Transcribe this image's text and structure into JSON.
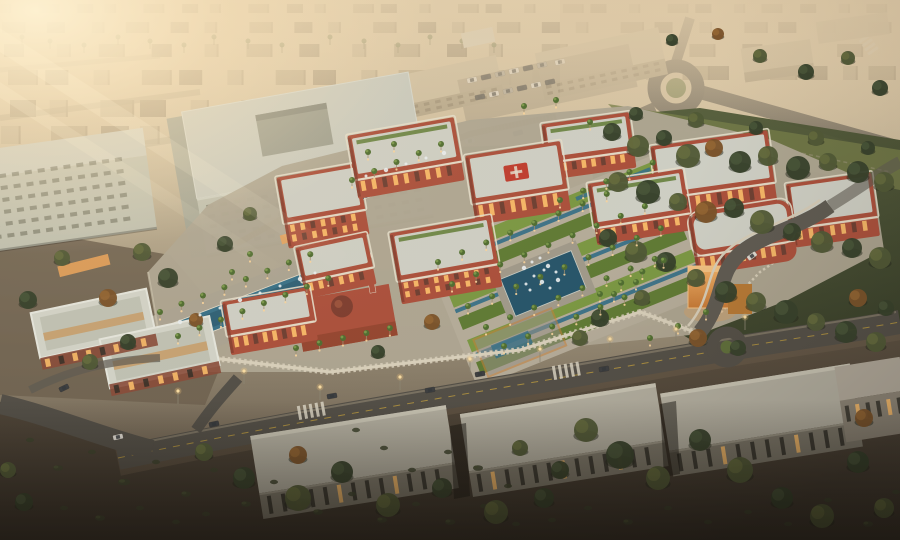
{
  "scene": {
    "description": "Aerial dusk rendering of a red-brick hospital campus with formal palm gardens, fountains, a mosque, a copper gate pavilion, surrounding roads with cars, long warehouse buildings and desert scrub, under a hazy golden sunset glare"
  },
  "palette": {
    "city1": "#b9ab8f",
    "city2": "#a89a7e",
    "city3": "#8d8069",
    "road": "#514e47",
    "roadLight": "#5f5c54",
    "bigFace": "#c2c4b4",
    "bigSide": "#a6a898",
    "bigRoof": "#cdcfc3",
    "pinkPatch": "#bd9a8e",
    "fence": "#9c7a4a",
    "red": "#ad4f3b",
    "redDark": "#7e3a2c",
    "trim": "#e9e2cf",
    "roofPale": "#d2d4ca",
    "lawn": "#5f7c34",
    "lawnBright": "#7b9a43",
    "water": "#35718a",
    "waterDeep": "#24556c",
    "palm": "#4e6e30",
    "palmLite": "#81a14f",
    "pave": "#b1a996",
    "wallCream": "#dcd4bf",
    "copper": "#cf8a3e",
    "copperLit": "#f2b366",
    "scrub": "#5e5242",
    "scrubDark": "#332d25",
    "whRoof": "#b5b2a4",
    "whFace": "#7c786b",
    "winDark": "#2c2a24",
    "winLit": "#ffc06a",
    "carW": "#e2dfd7",
    "carD": "#3a3d40",
    "carS": "#a9a59b",
    "treeA": "#33402a",
    "treeB": "#4e5835",
    "treeC": "#7b5229",
    "treeA2": "#49593a",
    "treeB2": "#68713f",
    "treeC2": "#9a6a33",
    "glow": "#ffd9a0"
  },
  "distant_city": {
    "rows": [
      {
        "y": 4,
        "h": 9,
        "n": 26,
        "x0": 0,
        "x1": 900,
        "s": 0.8
      },
      {
        "y": 22,
        "h": 11,
        "n": 22,
        "x0": 0,
        "x1": 900,
        "s": 0.9
      },
      {
        "y": 44,
        "h": 13,
        "n": 18,
        "x0": 0,
        "x1": 880,
        "s": 1.0
      },
      {
        "y": 66,
        "h": 14,
        "n": 8,
        "x0": 640,
        "x1": 900,
        "s": 1.05
      },
      {
        "y": 70,
        "h": 15,
        "n": 14,
        "x0": 0,
        "x1": 620,
        "s": 1.15
      },
      {
        "y": 100,
        "h": 17,
        "n": 9,
        "x0": 0,
        "x1": 420,
        "s": 1.3
      },
      {
        "y": 126,
        "h": 18,
        "n": 5,
        "x0": 0,
        "x1": 230,
        "s": 1.4
      }
    ]
  },
  "horizon_palms": [
    22,
    50,
    84,
    118,
    150,
    184,
    214,
    248,
    282,
    330,
    364,
    398,
    430,
    462,
    494
  ],
  "trees": [
    [
      612,
      132,
      9,
      0
    ],
    [
      638,
      146,
      11,
      1
    ],
    [
      664,
      138,
      8,
      0
    ],
    [
      688,
      156,
      12,
      1
    ],
    [
      714,
      148,
      9,
      2
    ],
    [
      740,
      162,
      11,
      0
    ],
    [
      768,
      156,
      10,
      1
    ],
    [
      798,
      168,
      12,
      0
    ],
    [
      828,
      162,
      9,
      1
    ],
    [
      858,
      172,
      11,
      0
    ],
    [
      884,
      182,
      10,
      1
    ],
    [
      618,
      182,
      10,
      1
    ],
    [
      648,
      192,
      12,
      0
    ],
    [
      678,
      202,
      9,
      1
    ],
    [
      706,
      212,
      11,
      2
    ],
    [
      734,
      208,
      10,
      0
    ],
    [
      762,
      222,
      12,
      1
    ],
    [
      792,
      232,
      9,
      0
    ],
    [
      822,
      242,
      11,
      1
    ],
    [
      852,
      248,
      10,
      0
    ],
    [
      880,
      258,
      11,
      1
    ],
    [
      608,
      238,
      9,
      0
    ],
    [
      636,
      252,
      11,
      1
    ],
    [
      666,
      262,
      10,
      0
    ],
    [
      696,
      278,
      9,
      1
    ],
    [
      726,
      292,
      11,
      0
    ],
    [
      756,
      302,
      10,
      1
    ],
    [
      786,
      312,
      12,
      0
    ],
    [
      816,
      322,
      9,
      1
    ],
    [
      846,
      332,
      11,
      0
    ],
    [
      876,
      342,
      10,
      1
    ],
    [
      698,
      338,
      9,
      2
    ],
    [
      738,
      348,
      8,
      0
    ],
    [
      642,
      298,
      8,
      1
    ],
    [
      600,
      318,
      9,
      0
    ],
    [
      580,
      338,
      8,
      1
    ],
    [
      858,
      298,
      9,
      2
    ],
    [
      886,
      308,
      8,
      0
    ],
    [
      636,
      114,
      7,
      0
    ],
    [
      696,
      120,
      8,
      1
    ],
    [
      756,
      128,
      7,
      0
    ],
    [
      816,
      138,
      8,
      1
    ],
    [
      868,
      148,
      7,
      0
    ],
    [
      760,
      56,
      7,
      1
    ],
    [
      806,
      72,
      8,
      0
    ],
    [
      848,
      58,
      7,
      1
    ],
    [
      880,
      88,
      8,
      0
    ],
    [
      718,
      34,
      6,
      2
    ],
    [
      672,
      40,
      6,
      0
    ],
    [
      142,
      252,
      9,
      1
    ],
    [
      168,
      278,
      10,
      0
    ],
    [
      108,
      298,
      9,
      2
    ],
    [
      62,
      258,
      8,
      1
    ],
    [
      28,
      300,
      9,
      0
    ],
    [
      90,
      362,
      8,
      1
    ],
    [
      128,
      342,
      8,
      0
    ],
    [
      196,
      320,
      7,
      2
    ],
    [
      432,
      322,
      8,
      2
    ],
    [
      378,
      352,
      7,
      0
    ],
    [
      250,
      214,
      7,
      1
    ],
    [
      225,
      244,
      8,
      0
    ],
    [
      204,
      452,
      9,
      1
    ],
    [
      244,
      478,
      11,
      0
    ],
    [
      298,
      498,
      13,
      1
    ],
    [
      342,
      472,
      11,
      0
    ],
    [
      298,
      455,
      9,
      2
    ],
    [
      388,
      505,
      12,
      1
    ],
    [
      442,
      488,
      10,
      0
    ],
    [
      496,
      512,
      12,
      1
    ],
    [
      544,
      498,
      10,
      0
    ],
    [
      586,
      430,
      12,
      1
    ],
    [
      620,
      455,
      14,
      0
    ],
    [
      658,
      478,
      12,
      1
    ],
    [
      700,
      440,
      11,
      0
    ],
    [
      740,
      470,
      13,
      1
    ],
    [
      782,
      498,
      11,
      0
    ],
    [
      822,
      516,
      12,
      1
    ],
    [
      858,
      462,
      11,
      0
    ],
    [
      884,
      508,
      10,
      1
    ],
    [
      864,
      418,
      9,
      2
    ],
    [
      560,
      470,
      9,
      0
    ],
    [
      520,
      448,
      8,
      1
    ],
    [
      24,
      502,
      9,
      0
    ],
    [
      8,
      470,
      8,
      1
    ]
  ],
  "shrubs": [
    [
      58,
      468,
      5
    ],
    [
      92,
      452,
      4
    ],
    [
      124,
      482,
      6
    ],
    [
      156,
      462,
      4
    ],
    [
      186,
      494,
      5
    ],
    [
      214,
      470,
      4
    ],
    [
      246,
      504,
      5
    ],
    [
      274,
      482,
      4
    ],
    [
      318,
      512,
      5
    ],
    [
      352,
      494,
      4
    ],
    [
      64,
      508,
      4
    ],
    [
      100,
      518,
      5
    ],
    [
      140,
      508,
      4
    ],
    [
      176,
      522,
      4
    ],
    [
      30,
      440,
      4
    ],
    [
      206,
      514,
      4
    ],
    [
      382,
      520,
      5
    ],
    [
      416,
      504,
      4
    ],
    [
      450,
      522,
      5
    ],
    [
      484,
      506,
      4
    ],
    [
      516,
      524,
      4
    ],
    [
      412,
      470,
      4
    ],
    [
      448,
      452,
      4
    ],
    [
      478,
      468,
      5
    ],
    [
      508,
      486,
      4
    ],
    [
      552,
      520,
      4
    ],
    [
      588,
      508,
      4
    ],
    [
      628,
      522,
      5
    ],
    [
      668,
      508,
      4
    ],
    [
      708,
      522,
      4
    ],
    [
      748,
      512,
      4
    ],
    [
      788,
      524,
      4
    ],
    [
      828,
      500,
      4
    ],
    [
      868,
      524,
      5
    ],
    [
      896,
      492,
      4
    ],
    [
      384,
      448,
      4
    ],
    [
      356,
      430,
      4
    ]
  ],
  "palm_rows": [
    {
      "x": 438,
      "y": 268,
      "n": 8,
      "st": 26,
      "a": -22
    },
    {
      "x": 452,
      "y": 290,
      "n": 9,
      "st": 26,
      "a": -22
    },
    {
      "x": 468,
      "y": 312,
      "n": 9,
      "st": 26,
      "a": -22
    },
    {
      "x": 486,
      "y": 333,
      "n": 8,
      "st": 26,
      "a": -22
    },
    {
      "x": 504,
      "y": 352,
      "n": 6,
      "st": 26,
      "a": -22
    },
    {
      "x": 160,
      "y": 318,
      "n": 8,
      "st": 23,
      "a": -21
    },
    {
      "x": 178,
      "y": 342,
      "n": 8,
      "st": 23,
      "a": -21
    },
    {
      "x": 352,
      "y": 186,
      "n": 5,
      "st": 24,
      "a": -22
    },
    {
      "x": 296,
      "y": 354,
      "n": 5,
      "st": 24,
      "a": -12
    },
    {
      "x": 560,
      "y": 206,
      "n": 5,
      "st": 25,
      "a": -22
    },
    {
      "x": 600,
      "y": 300,
      "n": 4,
      "st": 24,
      "a": -28
    }
  ],
  "palms": [
    [
      368,
      158
    ],
    [
      394,
      150
    ],
    [
      706,
      318
    ],
    [
      678,
      332
    ],
    [
      650,
      344
    ],
    [
      590,
      128
    ],
    [
      524,
      112
    ],
    [
      556,
      106
    ],
    [
      614,
      300
    ],
    [
      636,
      288
    ],
    [
      250,
      260
    ],
    [
      232,
      278
    ]
  ],
  "sprays": [
    [
      524,
      268
    ],
    [
      532,
      262
    ],
    [
      540,
      258
    ],
    [
      548,
      266
    ],
    [
      556,
      272
    ],
    [
      534,
      276
    ],
    [
      542,
      282
    ],
    [
      550,
      288
    ],
    [
      526,
      284
    ],
    [
      558,
      280
    ],
    [
      544,
      270
    ],
    [
      530,
      290
    ],
    [
      180,
      322
    ],
    [
      200,
      315
    ],
    [
      220,
      308
    ],
    [
      240,
      300
    ],
    [
      260,
      293
    ],
    [
      280,
      286
    ],
    [
      300,
      279
    ],
    [
      315,
      273
    ],
    [
      366,
      176
    ],
    [
      386,
      170
    ],
    [
      406,
      164
    ],
    [
      426,
      158
    ],
    [
      444,
      153
    ]
  ],
  "red_blocks": [
    {
      "x": 282,
      "y": 170,
      "w": 82,
      "h": 72,
      "f": 26,
      "r": -10
    },
    {
      "x": 352,
      "y": 126,
      "w": 108,
      "h": 64,
      "f": 20,
      "r": -10,
      "terrace": 1
    },
    {
      "x": 545,
      "y": 118,
      "w": 88,
      "h": 56,
      "f": 18,
      "r": -8,
      "terrace": 1
    },
    {
      "x": 470,
      "y": 148,
      "w": 96,
      "h": 70,
      "f": 22,
      "r": -9,
      "cross": 1
    },
    {
      "x": 655,
      "y": 138,
      "w": 118,
      "h": 74,
      "f": 22,
      "r": -8
    },
    {
      "x": 592,
      "y": 176,
      "w": 96,
      "h": 62,
      "f": 18,
      "r": -9,
      "terrace": 1
    },
    {
      "x": 790,
      "y": 178,
      "w": 86,
      "h": 64,
      "f": 20,
      "r": -8
    },
    {
      "x": 692,
      "y": 206,
      "w": 102,
      "h": 62,
      "f": 20,
      "r": -9,
      "round": 1
    },
    {
      "x": 395,
      "y": 224,
      "w": 102,
      "h": 72,
      "f": 24,
      "r": -10,
      "terrace": 1
    },
    {
      "x": 300,
      "y": 240,
      "w": 72,
      "h": 52,
      "f": 18,
      "r": -12
    },
    {
      "x": 226,
      "y": 294,
      "w": 88,
      "h": 54,
      "f": 20,
      "r": -10
    }
  ],
  "warehouses": [
    {
      "x": 256,
      "y": 420,
      "w": 198,
      "hr": 58,
      "hf": 26,
      "r": -9,
      "cx": 355,
      "cy": 465,
      "n": 13,
      "lit": [
        2,
        5,
        9
      ]
    },
    {
      "x": 466,
      "y": 398,
      "w": 198,
      "hr": 58,
      "hf": 26,
      "r": -9,
      "cx": 565,
      "cy": 445,
      "n": 13,
      "lit": [
        1,
        6,
        10
      ]
    },
    {
      "x": 666,
      "y": 378,
      "w": 192,
      "hr": 58,
      "hf": 26,
      "r": -9,
      "cx": 762,
      "cy": 423,
      "n": 12,
      "lit": [
        3,
        8
      ]
    }
  ],
  "strip_windows": [
    {
      "x": 844,
      "y": 402,
      "n": 6,
      "w": 4,
      "h": 16,
      "step": 10.5,
      "lit": [
        1,
        4
      ],
      "rot": -9,
      "cx": 870,
      "cy": 400
    },
    {
      "x": 40,
      "y": 344,
      "n": 8,
      "w": 5,
      "h": 8,
      "step": 14,
      "lit": [
        0,
        2,
        3,
        5,
        7
      ],
      "rot": -12,
      "cx": 115,
      "cy": 330
    },
    {
      "x": 102,
      "y": 384,
      "n": 7,
      "w": 5,
      "h": 8,
      "step": 15,
      "lit": [
        1,
        3,
        4,
        6
      ],
      "rot": -12,
      "cx": 115,
      "cy": 330
    }
  ],
  "grids": [
    {
      "x": 198,
      "y": 188,
      "c": 16,
      "r": 5,
      "dx": 13.8,
      "dy": 10,
      "w": 7,
      "h": 3.6,
      "f": "#565848",
      "o": 0.6,
      "rot": -10,
      "cx": 300,
      "cy": 150,
      "layer": "main"
    },
    {
      "x": -10,
      "y": 166,
      "c": 11,
      "r": 6,
      "dx": 13,
      "dy": 12,
      "w": 7,
      "h": 4,
      "f": "#565848",
      "o": 0.5,
      "rot": -8,
      "cx": 60,
      "cy": 200,
      "layer": "main"
    },
    {
      "x": 542,
      "y": 74,
      "c": 11,
      "r": 2,
      "dx": 11,
      "dy": 6.5,
      "w": 5.5,
      "h": 3,
      "f": "#6f6452",
      "o": 0.6,
      "rot": -12,
      "cx": 600,
      "cy": 62,
      "layer": "top"
    },
    {
      "x": 408,
      "y": 96,
      "c": 8,
      "r": 2,
      "dx": 11.5,
      "dy": 6,
      "w": 5.5,
      "h": 3,
      "f": "#6f6452",
      "o": 0.6,
      "rot": -12,
      "cx": 455,
      "cy": 80,
      "layer": "top"
    }
  ],
  "cars_top": [
    [
      424,
      149,
      -10,
      "d"
    ],
    [
      470,
      141,
      -10,
      "w"
    ],
    [
      518,
      133,
      -14,
      "d"
    ],
    [
      472,
      80,
      -12,
      "w"
    ],
    [
      486,
      77,
      -12,
      "d"
    ],
    [
      500,
      74,
      -12,
      "s"
    ],
    [
      514,
      71,
      -12,
      "w"
    ],
    [
      528,
      68,
      -12,
      "d"
    ],
    [
      542,
      65,
      -12,
      "s"
    ],
    [
      480,
      97,
      -12,
      "d"
    ],
    [
      494,
      94,
      -12,
      "w"
    ],
    [
      508,
      91,
      -12,
      "s"
    ],
    [
      522,
      88,
      -12,
      "d"
    ],
    [
      536,
      85,
      -12,
      "w"
    ],
    [
      550,
      82,
      -12,
      "d"
    ],
    [
      560,
      62,
      -12,
      "w"
    ]
  ],
  "cars": [
    [
      118,
      437,
      -12,
      "w"
    ],
    [
      64,
      388,
      -26,
      "d"
    ],
    [
      332,
      396,
      -10,
      "d"
    ],
    [
      430,
      390,
      -10,
      "d"
    ],
    [
      480,
      374,
      -10,
      "d"
    ],
    [
      604,
      369,
      -9,
      "d"
    ],
    [
      752,
      256,
      -36,
      "w"
    ],
    [
      214,
      424,
      -12,
      "d"
    ]
  ],
  "lamps": [
    [
      178,
      404
    ],
    [
      244,
      384
    ],
    [
      320,
      400
    ],
    [
      400,
      390
    ],
    [
      470,
      372
    ],
    [
      540,
      362
    ],
    [
      610,
      352
    ],
    [
      676,
      342
    ],
    [
      745,
      330
    ]
  ]
}
